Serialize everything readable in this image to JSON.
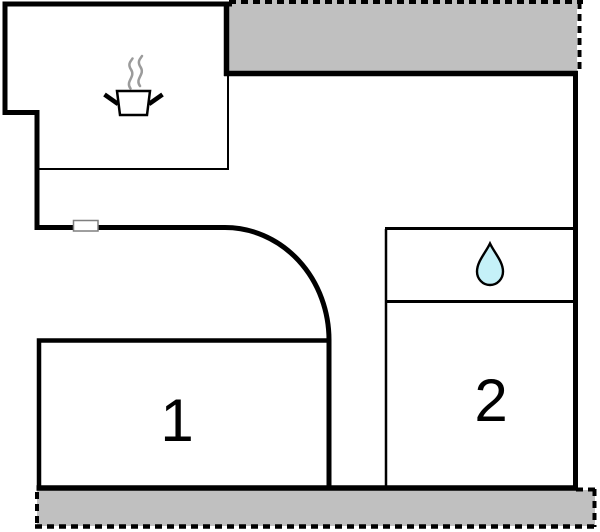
{
  "colors": {
    "background": "#ffffff",
    "wall": "#000000",
    "terrace_fill": "#c0c0c0",
    "steam": "#9b9b9b",
    "water_drop_fill": "#c5f1f8",
    "window_frame": "#7f7f7f",
    "label": "#000000"
  },
  "rooms": {
    "room1": {
      "label": "1"
    },
    "room2": {
      "label": "2"
    }
  },
  "icons": {
    "kitchen": "cooking-pot-steam-icon",
    "bathroom": "water-drop-icon"
  }
}
